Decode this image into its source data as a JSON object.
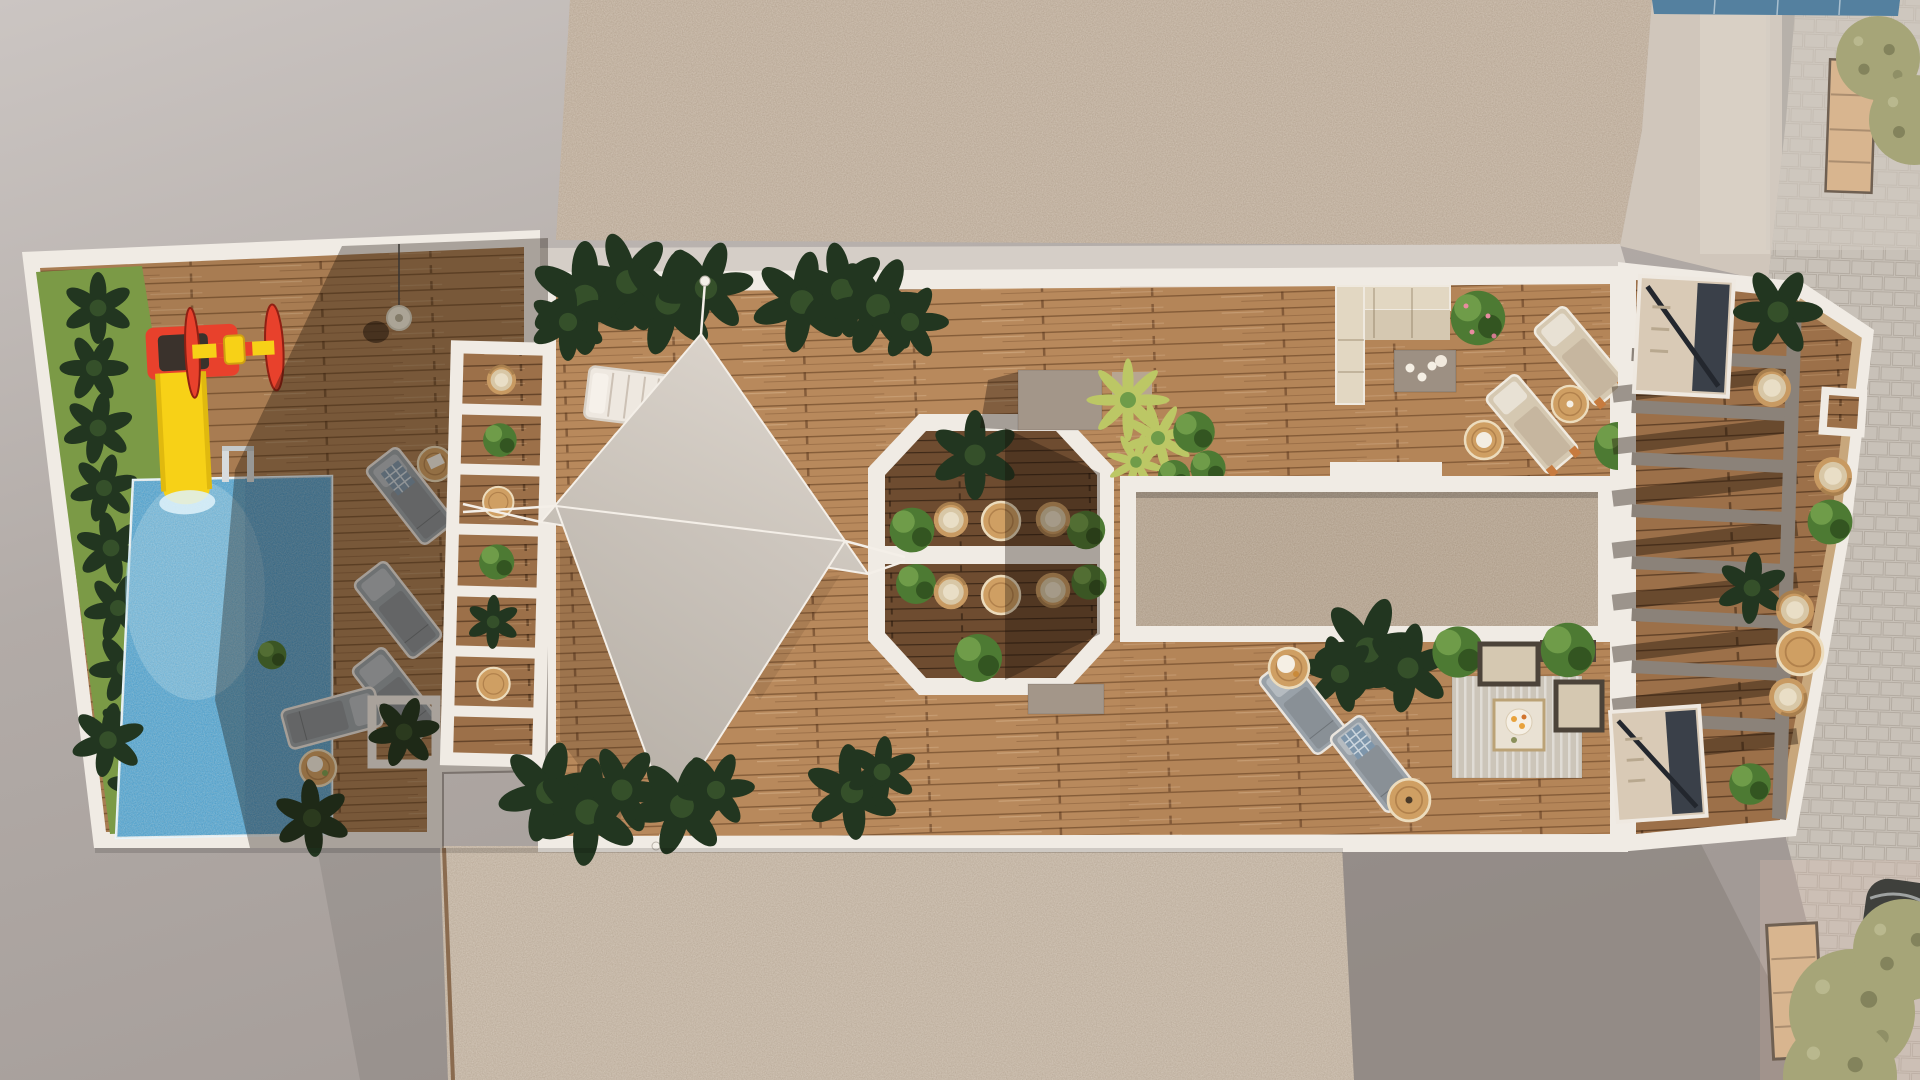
{
  "scene": {
    "description": "Top-down 3D architectural rendering of a long rooftop terrace with pool, playground, shade sails, octagonal dining nook, lounge areas, slatted pergola deck and adjacent street",
    "areas": [
      "children-playground",
      "swimming-pool",
      "poolside-sun-loungers",
      "white-pergola-planter-ladder",
      "shade-sail-deck",
      "octagonal-dining-nook",
      "skylight-gravel-bed",
      "outdoor-living-room",
      "tanning-lounge-chairs",
      "slatted-pergola-deck",
      "stairwell-canopies",
      "street-with-parked-car"
    ]
  },
  "palette": {
    "concrete_light": "#cbc5c2",
    "concrete": "#b2aba7",
    "concrete_dark": "#a29a96",
    "gravel": "#c6b5a3",
    "gravel_dark": "#b7a591",
    "gravel_bottom": "#c9baa9",
    "white_trim": "#f0ebe4",
    "white_trim_dim": "#ddd6cd",
    "wood_light": "#b8895c",
    "wood_mid": "#9c7049",
    "wood_dark": "#6e4c30",
    "pool_blue": "#3f9ed3",
    "pool_light": "#9fd4ef",
    "pool_deep": "#1f72b8",
    "grass": "#7b9a46",
    "plant_dark": "#223620",
    "plant_mid": "#35502a",
    "plant_green": "#4d7a33",
    "plant_light": "#6f9c49",
    "palm_yellow": "#bcc765",
    "play_red": "#e8412c",
    "play_yellow": "#f7d117",
    "lounger_gray": "#99a1a8",
    "beige": "#d5c8b1",
    "beige_light": "#e2d7c2",
    "rattan": "#c89a62",
    "wood_table": "#cf9f63",
    "taupe_box": "#a39689",
    "beam_gray": "#8b8279",
    "stair_canopy": "#d9cab6",
    "stair_dark": "#3a4049",
    "street": "#c8c1b8",
    "street_light": "#d3ccc3",
    "awning": "#d8b58f",
    "tree_olive": "#a6a578",
    "solar_blue": "#54809f",
    "car_dark": "#3f403c",
    "sail_a": "#ddd6ce",
    "sail_b": "#cfc8c0",
    "rug": "#ccc5b9",
    "building": "#d0c6bb"
  }
}
